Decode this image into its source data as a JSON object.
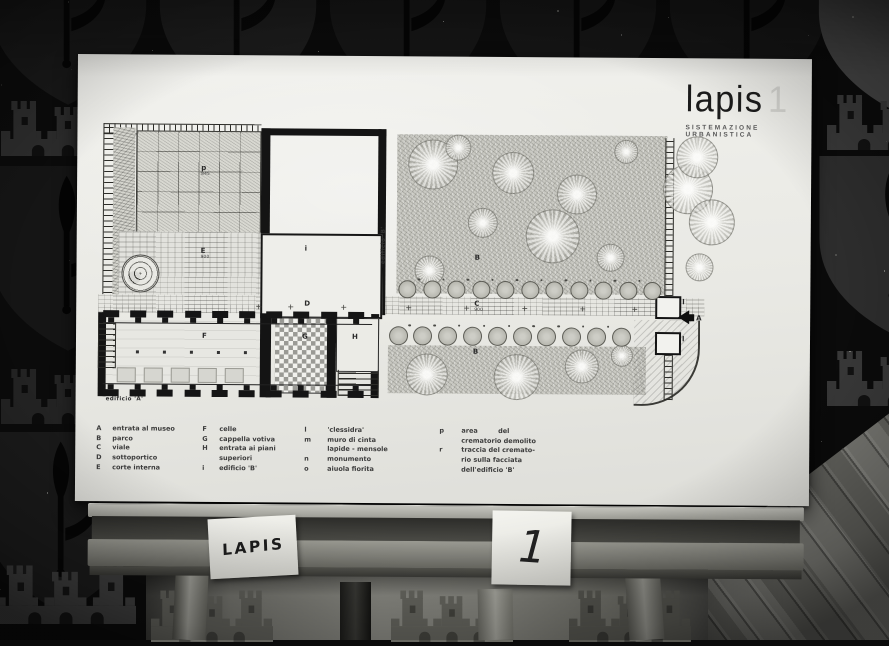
{
  "photo": {
    "cards": {
      "left": "LAPIS",
      "right": "1"
    }
  },
  "board": {
    "title": "lapis",
    "title_number": "1",
    "subtitle": "SISTEMAZIONE URBANISTICA",
    "captions": {
      "edificio_a": "edificio 'A'",
      "edificio_b": "edificio 'B'"
    },
    "area_labels": [
      {
        "key": "p",
        "sub": "845",
        "x": 124,
        "y": 110
      },
      {
        "key": "E",
        "sub": "900",
        "x": 124,
        "y": 193
      },
      {
        "key": "i",
        "x": 228,
        "y": 190
      },
      {
        "key": "D",
        "x": 228,
        "y": 245
      },
      {
        "key": "F",
        "x": 126,
        "y": 278
      },
      {
        "key": "G",
        "x": 226,
        "y": 278
      },
      {
        "key": "H",
        "x": 276,
        "y": 278
      },
      {
        "key": "B",
        "x": 398,
        "y": 198
      },
      {
        "key": "C",
        "sub": "900",
        "x": 398,
        "y": 244
      },
      {
        "key": "B",
        "x": 397,
        "y": 292
      },
      {
        "key": "A",
        "x": 620,
        "y": 257
      },
      {
        "key": "l",
        "x": 606,
        "y": 241
      },
      {
        "key": "l",
        "x": 606,
        "y": 278
      }
    ],
    "legend": {
      "columns": [
        {
          "entries": [
            {
              "key": "A",
              "lines": [
                "entrata al museo"
              ]
            },
            {
              "key": "B",
              "lines": [
                "parco"
              ]
            },
            {
              "key": "C",
              "lines": [
                "viale"
              ]
            },
            {
              "key": "D",
              "lines": [
                "sottoportico"
              ]
            },
            {
              "key": "E",
              "lines": [
                "corte interna"
              ]
            }
          ]
        },
        {
          "entries": [
            {
              "key": "F",
              "lines": [
                "celle"
              ]
            },
            {
              "key": "G",
              "lines": [
                "cappella votiva"
              ]
            },
            {
              "key": "H",
              "lines": [
                "entrata ai piani",
                "superiori"
              ]
            },
            {
              "key": "i",
              "lines": [
                "edificio 'B'"
              ]
            }
          ]
        },
        {
          "entries": [
            {
              "key": "l",
              "lines": [
                "'clessidra'"
              ]
            },
            {
              "key": "m",
              "lines": [
                "muro di cinta",
                "lapide - mensole"
              ]
            },
            {
              "key": "n",
              "lines": [
                "monumento"
              ]
            },
            {
              "key": "o",
              "lines": [
                "aiuola fiorita"
              ]
            }
          ]
        },
        {
          "entries": [
            {
              "key": "p",
              "lines": [
                "area         del",
                "crematorio demolito"
              ]
            },
            {
              "key": "r",
              "lines": [
                "traccia del cremato-",
                "rio sulla facciata",
                "dell'edificio 'B'"
              ]
            }
          ]
        }
      ]
    }
  },
  "geometry": {
    "legend_columns": [
      {
        "kx": 21,
        "tx": 37
      },
      {
        "kx": 127,
        "tx": 144
      },
      {
        "kx": 229,
        "tx": 252
      },
      {
        "kx": 364,
        "tx": 386
      }
    ],
    "legend_top": 370,
    "trees_big": [
      [
        355,
        107,
        24
      ],
      [
        435,
        115,
        20
      ],
      [
        499,
        136,
        19
      ],
      [
        610,
        130,
        24
      ],
      [
        475,
        178,
        26
      ],
      [
        405,
        165,
        14
      ],
      [
        533,
        199,
        13
      ],
      [
        352,
        213,
        14
      ],
      [
        548,
        93,
        11
      ],
      [
        380,
        90,
        12
      ],
      [
        619,
        98,
        20
      ],
      [
        634,
        163,
        22
      ],
      [
        622,
        208,
        13
      ]
    ],
    "trees_lower": [
      [
        350,
        317,
        20
      ],
      [
        440,
        319,
        22
      ],
      [
        505,
        308,
        16
      ],
      [
        545,
        297,
        10
      ]
    ],
    "tree_rows": [
      {
        "y": 232,
        "x0": 330,
        "step": 24.5,
        "count": 11,
        "r": 8
      },
      {
        "y": 278,
        "x0": 321,
        "step": 24.8,
        "count": 10,
        "r": 8.5
      }
    ],
    "pilaster_rows": [
      {
        "x0": 31,
        "y": 256,
        "count": 10,
        "step": 27.2,
        "stem": "down"
      },
      {
        "x0": 31,
        "y": 329,
        "count": 10,
        "step": 27.2,
        "stem": "up"
      }
    ],
    "column_dots": {
      "y": 296,
      "xs": [
        60,
        87,
        114,
        141,
        168
      ]
    },
    "doors": {
      "y": 313,
      "xs": [
        41,
        68,
        95,
        122,
        149
      ],
      "w": 17,
      "h": 13
    },
    "corridor_ticks": {
      "y": 249,
      "xs": [
        180,
        212,
        265,
        330,
        388,
        446,
        504,
        556
      ]
    }
  },
  "wallpaper": {
    "motifs": [
      {
        "type": "shield",
        "cx": 68,
        "y": -80,
        "w": 170,
        "h": 188,
        "fill": "#191919",
        "detail": "#060606",
        "layer": "bg"
      },
      {
        "type": "shield",
        "cx": 238,
        "y": -80,
        "w": 170,
        "h": 188,
        "fill": "#1d1d1d",
        "detail": "#070707",
        "layer": "bg"
      },
      {
        "type": "shield",
        "cx": 408,
        "y": -80,
        "w": 170,
        "h": 188,
        "fill": "#161616",
        "detail": "#050505",
        "layer": "bg"
      },
      {
        "type": "shield",
        "cx": 578,
        "y": -80,
        "w": 170,
        "h": 188,
        "fill": "#161616",
        "detail": "#050505",
        "layer": "bg"
      },
      {
        "type": "shield",
        "cx": 748,
        "y": -80,
        "w": 170,
        "h": 188,
        "fill": "#161616",
        "detail": "#050505",
        "layer": "bg"
      },
      {
        "type": "shield",
        "cx": 898,
        "y": -74,
        "w": 172,
        "h": 190,
        "fill": "#464646",
        "detail": "#121212",
        "layer": "bg"
      },
      {
        "type": "castle",
        "cx": 68,
        "y": 94,
        "w": 134,
        "h": 62,
        "fill": "#2d2d2d",
        "detail": "#0f0f0f",
        "layer": "bg"
      },
      {
        "type": "castle",
        "cx": 894,
        "y": 88,
        "w": 134,
        "h": 62,
        "fill": "#3a3a3a",
        "detail": "#121212",
        "layer": "bg"
      },
      {
        "type": "shield",
        "cx": 68,
        "y": 166,
        "w": 170,
        "h": 188,
        "fill": "#151515",
        "detail": "#040404",
        "layer": "bg"
      },
      {
        "type": "shield",
        "cx": 894,
        "y": 156,
        "w": 162,
        "h": 182,
        "fill": "#2e2e2e",
        "detail": "#080808",
        "layer": "bg"
      },
      {
        "type": "castle",
        "cx": 68,
        "y": 362,
        "w": 134,
        "h": 62,
        "fill": "#242424",
        "detail": "#0c0c0c",
        "layer": "bg"
      },
      {
        "type": "castle",
        "cx": 894,
        "y": 344,
        "w": 134,
        "h": 62,
        "fill": "#3a3a3a",
        "detail": "#121212",
        "layer": "bg"
      },
      {
        "type": "shield",
        "cx": 62,
        "y": 432,
        "w": 166,
        "h": 184,
        "fill": "#1b1b1b",
        "detail": "#060606",
        "layer": "bg"
      },
      {
        "type": "castle",
        "cx": 66,
        "y": 558,
        "w": 140,
        "h": 66,
        "fill": "#3f3f3f",
        "detail": "#151515",
        "layer": "bg"
      },
      {
        "type": "castle",
        "cx": 212,
        "y": 584,
        "w": 122,
        "h": 58,
        "fill": "#62625c",
        "detail": "#42423e",
        "layer": "wall"
      },
      {
        "type": "castle",
        "cx": 452,
        "y": 584,
        "w": 122,
        "h": 58,
        "fill": "#686861",
        "detail": "#464640",
        "layer": "wall"
      },
      {
        "type": "castle",
        "cx": 630,
        "y": 584,
        "w": 122,
        "h": 58,
        "fill": "#575751",
        "detail": "#3a3a36",
        "layer": "wall"
      }
    ]
  },
  "colors": {
    "background": "#0b0b0b",
    "board": "#e9e9e5",
    "ink": "#1b1b1b",
    "wood_light": "#9a9a93",
    "wood_dark": "#4a4a45",
    "floor": "#74746e"
  }
}
